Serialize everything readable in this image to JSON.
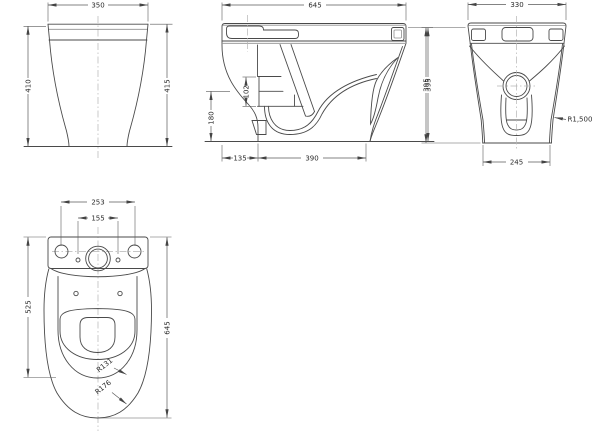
{
  "colors": {
    "line": "#4a4a4a",
    "dim_line": "#5a5a5a",
    "light_line": "#8f8f8f",
    "centerline": "#b5b5b5",
    "text": "#2b2b2b",
    "background": "#ffffff"
  },
  "views": {
    "front": {
      "dims": {
        "width": "350",
        "height_left": "410",
        "height_right": "415"
      }
    },
    "side": {
      "dims": {
        "overall_depth": "645",
        "tank_height": "102",
        "water_level_height": "180",
        "front_offset": "135",
        "base_depth": "390",
        "overall_height": "395"
      }
    },
    "back": {
      "dims": {
        "width": "330",
        "overall_height": "395",
        "base_width": "245",
        "side_radius": "R1,500"
      }
    },
    "plan": {
      "dims": {
        "hole_spacing_outer": "253",
        "hole_spacing_inner": "155",
        "cistern_to_seat_length": "525",
        "overall_length": "645",
        "seat_radius": "R131",
        "bowl_radius": "R176"
      }
    }
  }
}
